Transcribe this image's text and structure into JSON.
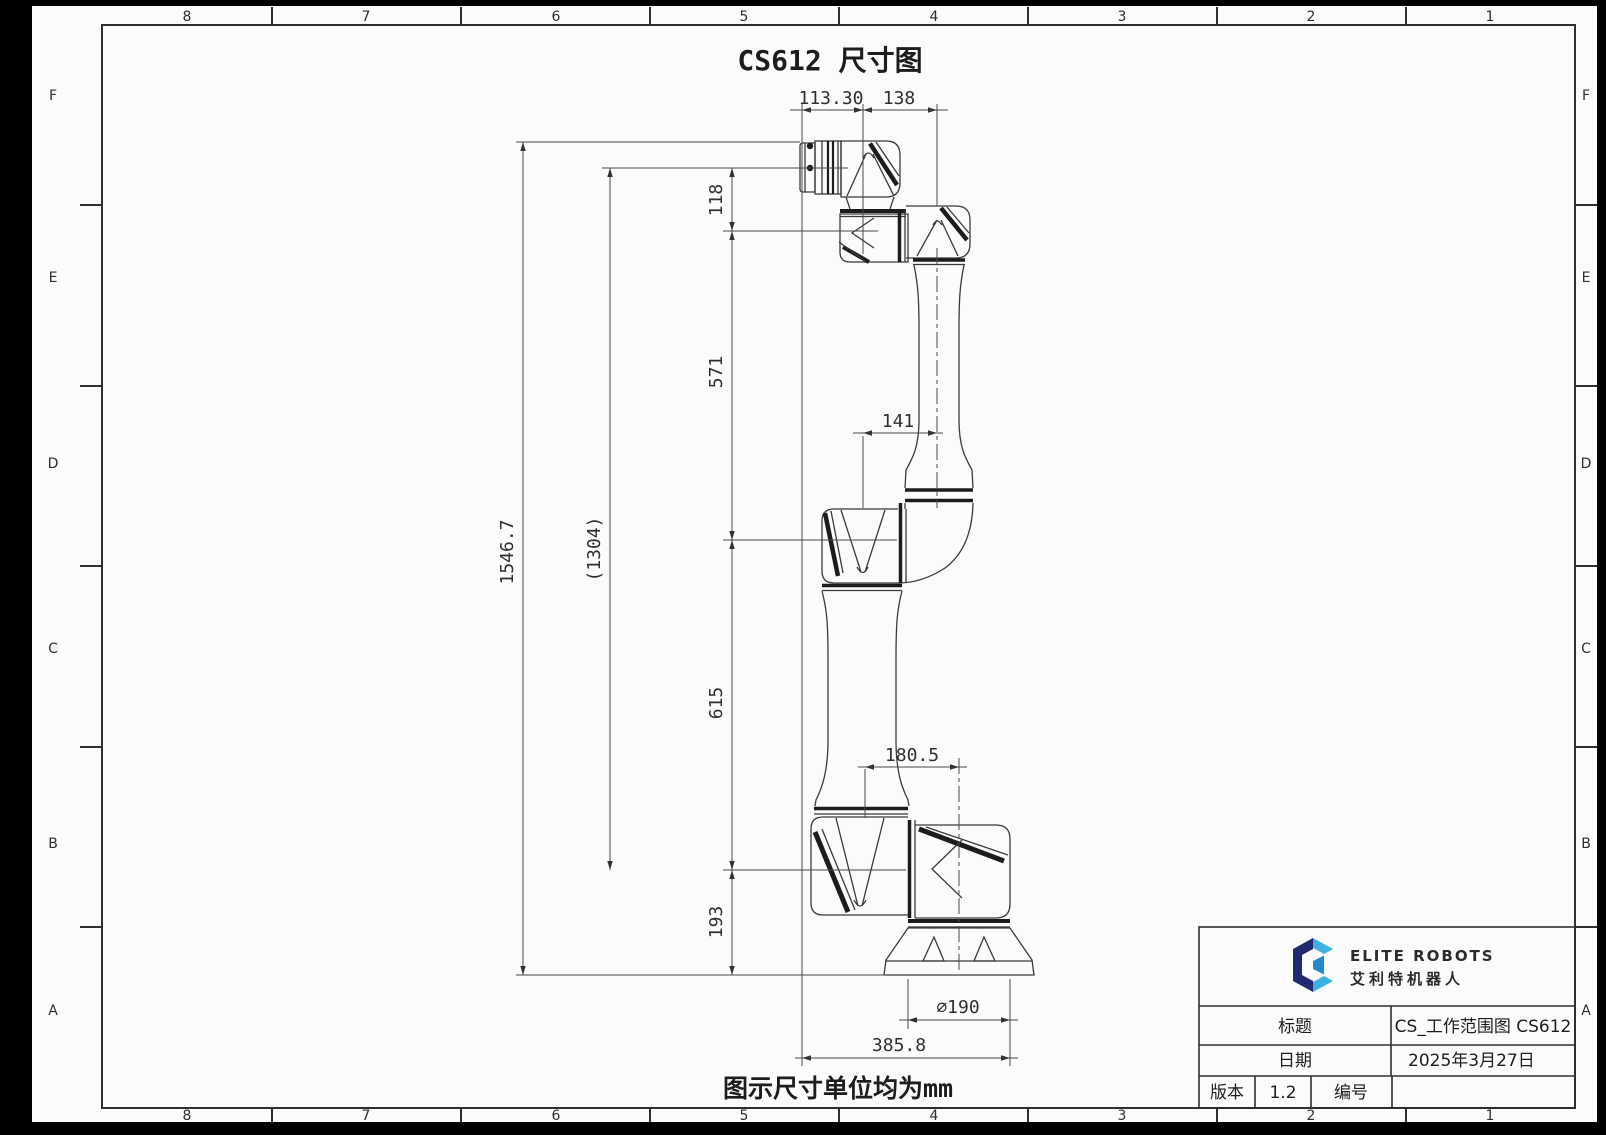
{
  "sheet": {
    "title": "CS612 尺寸图",
    "note": "图示尺寸单位均为mm",
    "zone_columns": [
      "8",
      "7",
      "6",
      "5",
      "4",
      "3",
      "2",
      "1"
    ],
    "zone_rows": [
      "F",
      "E",
      "D",
      "C",
      "B",
      "A"
    ]
  },
  "dims": {
    "flange_to_wrist_axis": "113.30",
    "wrist_axis_to_forearm_axis": "138",
    "wrist3_to_wrist2": "118",
    "wrist2_to_elbow": "571",
    "total_height": "1546.7",
    "flange_to_shoulder": "(1304)",
    "elbow_offset": "141",
    "elbow_to_shoulder": "615",
    "shoulder_offset": "180.5",
    "shoulder_to_base": "193",
    "base_diameter": "∅190",
    "overall_width": "385.8"
  },
  "title_block": {
    "brand_en": "ELITE ROBOTS",
    "brand_cn": "艾利特机器人",
    "title_label": "标题",
    "title_value": "CS_工作范围图 CS612",
    "date_label": "日期",
    "date_value": "2025年3月27日",
    "version_label": "版本",
    "version_value": "1.2",
    "number_label": "编号",
    "number_value": ""
  },
  "colors": {
    "logo_navy": "#212a6e",
    "logo_blue": "#3fb0e4",
    "logo_mid": "#2488cf"
  }
}
